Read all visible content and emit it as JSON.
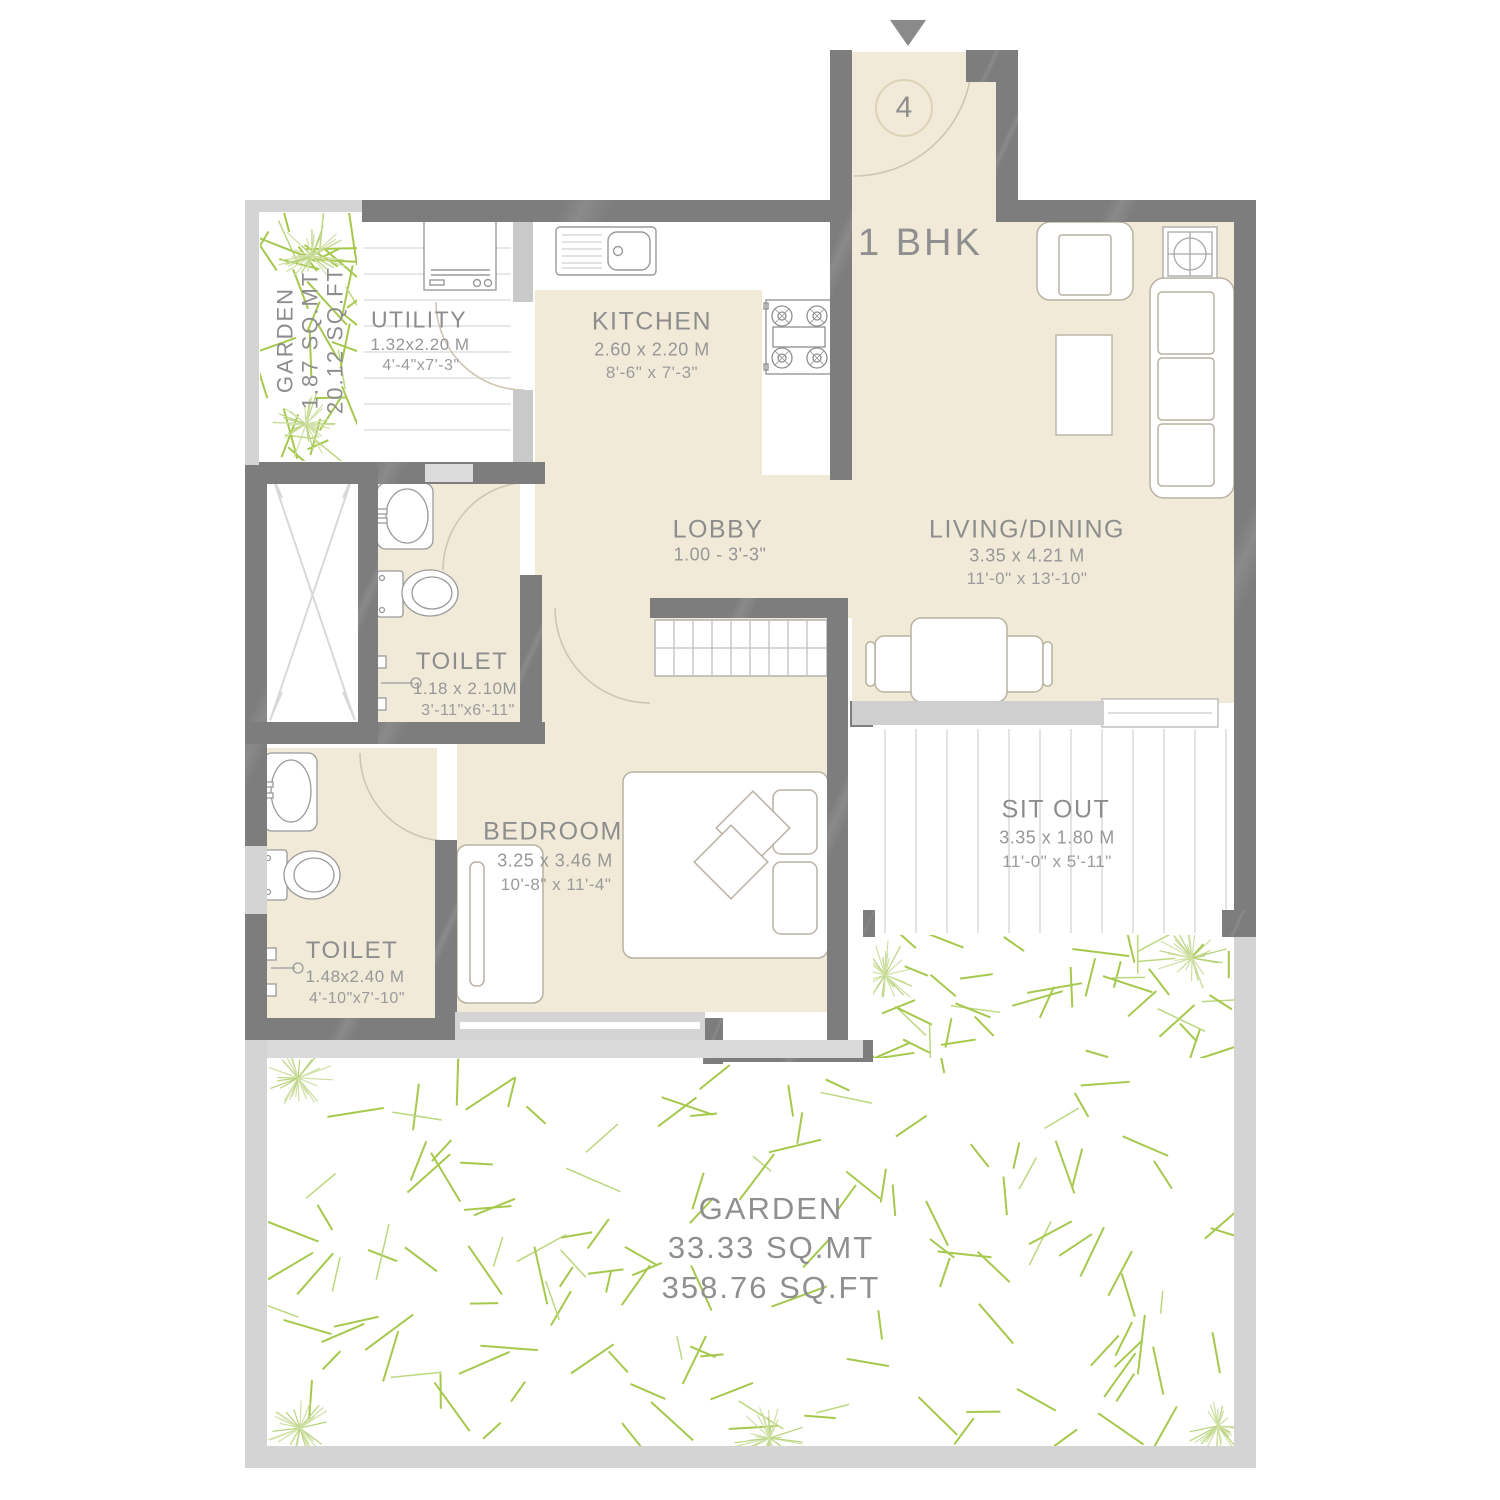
{
  "plan": {
    "unit_label": "1 BHK",
    "entrance_number": "4",
    "rooms": [
      {
        "id": "utility",
        "name": "UTILITY",
        "dim_m": "1.32x2.20 M",
        "dim_ft": "4'-4\"x7'-3\""
      },
      {
        "id": "kitchen",
        "name": "KITCHEN",
        "dim_m": "2.60 x 2.20 M",
        "dim_ft": "8'-6\" x 7'-3\""
      },
      {
        "id": "lobby",
        "name": "LOBBY",
        "dim_m": "1.00 - 3'-3\""
      },
      {
        "id": "living_dining",
        "name": "LIVING/DINING",
        "dim_m": "3.35 x 4.21 M",
        "dim_ft": "11'-0\" x 13'-10\""
      },
      {
        "id": "toilet_upper",
        "name": "TOILET",
        "dim_m": "1.18 x 2.10M",
        "dim_ft": "3'-11\"x6'-11\""
      },
      {
        "id": "toilet_lower",
        "name": "TOILET",
        "dim_m": "1.48x2.40 M",
        "dim_ft": "4'-10\"x7'-10\""
      },
      {
        "id": "bedroom",
        "name": "BEDROOM",
        "dim_m": "3.25 x 3.46 M",
        "dim_ft": "10'-8\" x 11'-4\""
      },
      {
        "id": "sit_out",
        "name": "SIT OUT",
        "dim_m": "3.35 x 1.80 M",
        "dim_ft": "11'-0\" x 5'-11\""
      },
      {
        "id": "garden_small",
        "name": "GARDEN",
        "dim_m": "1.87 SQ.MT",
        "dim_ft": "20.12 SQ.FT"
      },
      {
        "id": "garden_large",
        "name": "GARDEN",
        "dim_m": "33.33 SQ.MT",
        "dim_ft": "358.76 SQ.FT"
      }
    ],
    "colors": {
      "wall": "#7d7d7d",
      "floor": "#f1ead9",
      "window": "#d4d4d4",
      "grass": "#a5c84d",
      "grass_light": "#cfe0a4",
      "label_text": "#8d8d8d",
      "door_arc": "#cfc6b2"
    }
  }
}
